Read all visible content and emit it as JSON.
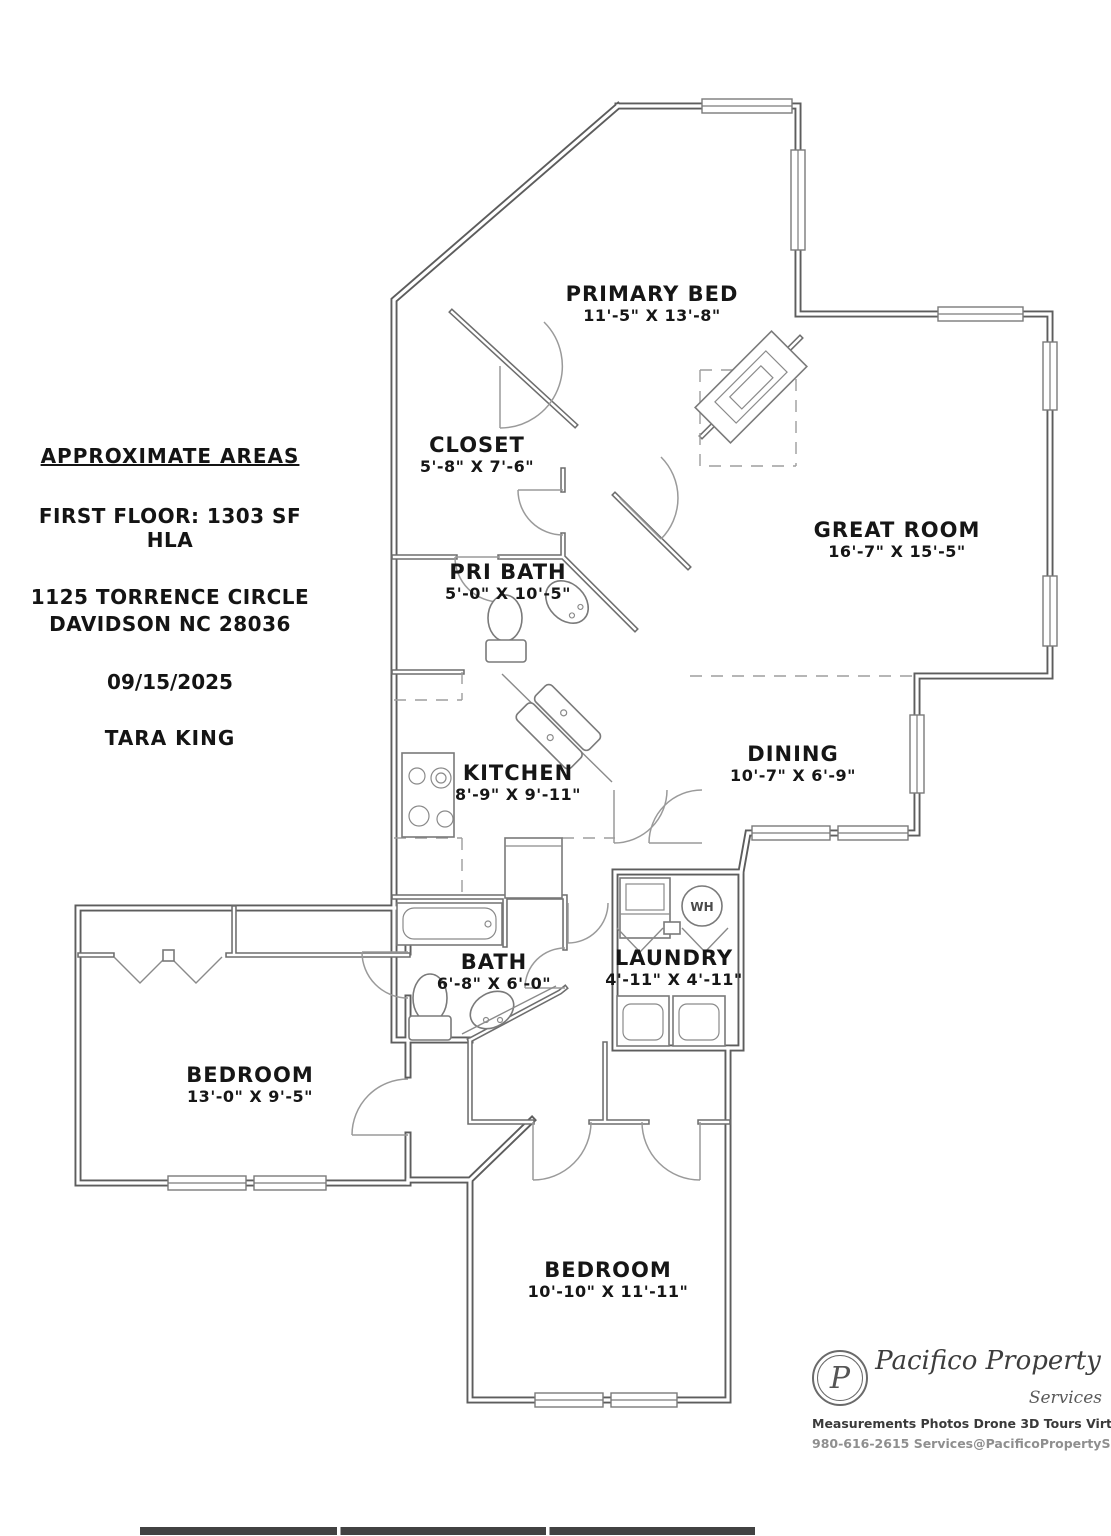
{
  "info_panel": {
    "title": "APPROXIMATE AREAS",
    "floor_area": "FIRST FLOOR: 1303 SF HLA",
    "address_line1": "1125 TORRENCE CIRCLE",
    "address_line2": "DAVIDSON NC 28036",
    "date": "09/15/2025",
    "agent": "TARA KING"
  },
  "rooms": [
    {
      "name": "PRIMARY BED",
      "dims": "11'-5\" X 13'-8\""
    },
    {
      "name": "CLOSET",
      "dims": "5'-8\" X 7'-6\""
    },
    {
      "name": "PRI BATH",
      "dims": "5'-0\" X 10'-5\""
    },
    {
      "name": "GREAT ROOM",
      "dims": "16'-7\" X 15'-5\""
    },
    {
      "name": "KITCHEN",
      "dims": "8'-9\" X 9'-11\""
    },
    {
      "name": "DINING",
      "dims": "10'-7\" X 6'-9\""
    },
    {
      "name": "BATH",
      "dims": "6'-8\" X 6'-0\""
    },
    {
      "name": "LAUNDRY",
      "dims": "4'-11\" X 4'-11\""
    },
    {
      "name": "BEDROOM",
      "dims": "13'-0\" X 9'-5\""
    },
    {
      "name": "BEDROOM",
      "dims": "10'-10\" X 11'-11\""
    }
  ],
  "labels": {
    "water_heater": "WH"
  },
  "branding": {
    "monogram": "P",
    "company": "Pacifico Property",
    "tagline": "Services",
    "services_line": "Measurements Photos Drone 3D Tours Virtual Staging",
    "contact_line": "980-616-2615 Services@PacificoPropertyServices.com"
  },
  "colors": {
    "wall": "#5d5d5d",
    "text": "#161616",
    "brand_text": "#3d3d3d",
    "background": "#ffffff"
  }
}
